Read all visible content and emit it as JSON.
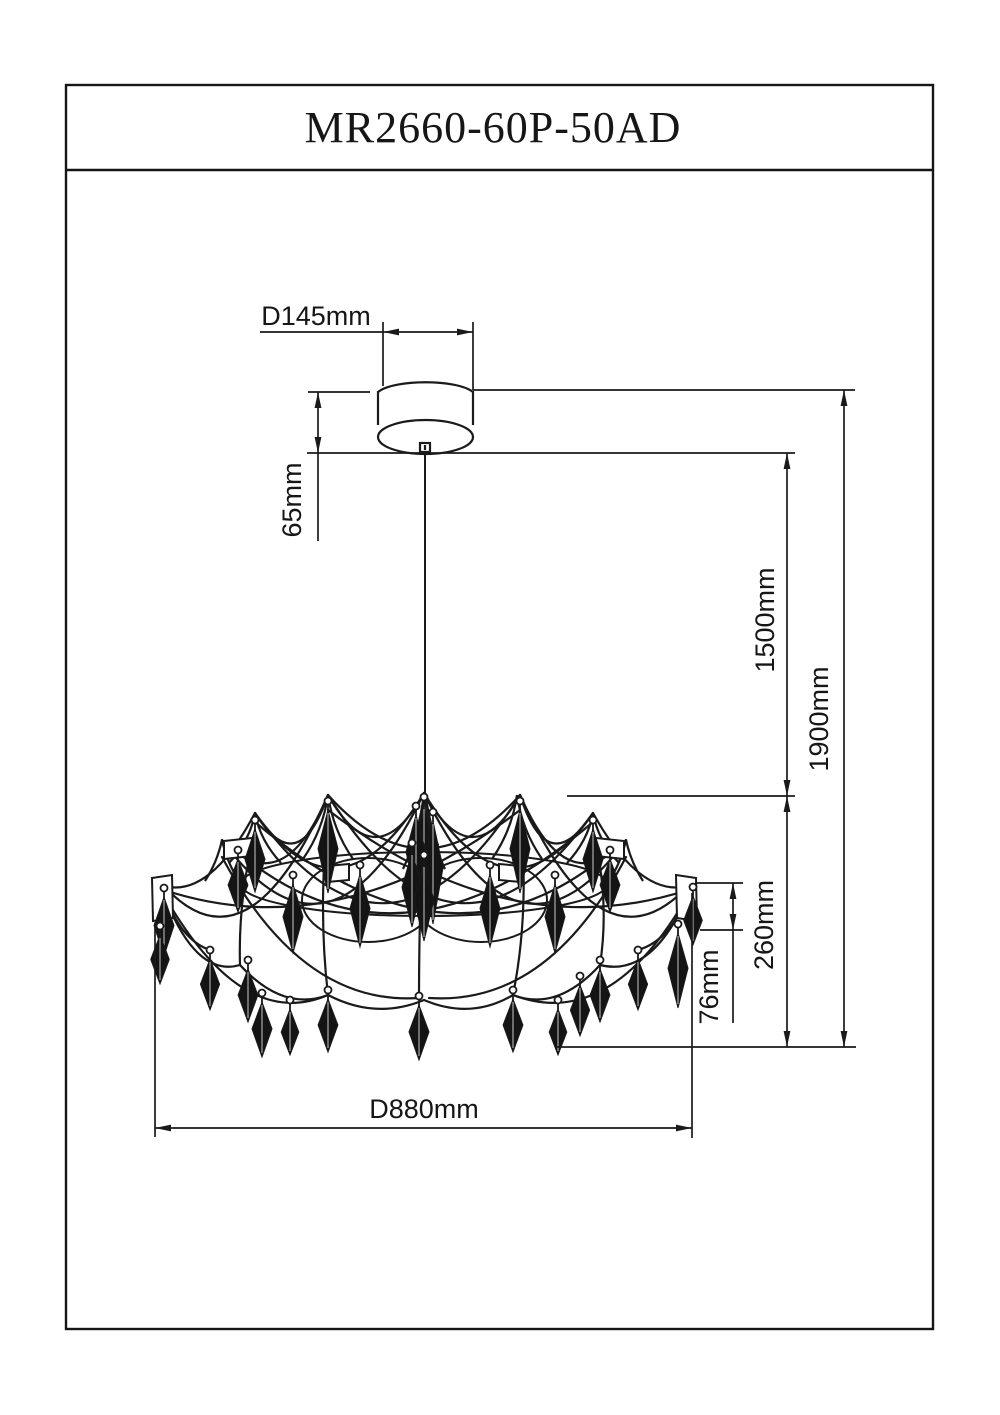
{
  "title": "MR2660-60P-50AD",
  "dimensions": {
    "canopy_diameter": "D145mm",
    "canopy_height": "65mm",
    "cable_length": "1500mm",
    "overall_height": "1900mm",
    "body_height": "260mm",
    "crystal_drop_length": "76mm",
    "fixture_diameter": "D880mm"
  },
  "drawing": {
    "stroke_color": "#1a1a1a",
    "frame": {
      "x": 66,
      "y": 85,
      "w": 867,
      "h": 1244,
      "title_sep_y": 170
    },
    "canopy": {
      "left": 378,
      "right": 473,
      "top": 386,
      "side_bottom": 424,
      "ellipse_cy": 437,
      "ellipse_ry": 17,
      "connector": {
        "x": 420,
        "y": 443,
        "w": 10,
        "h": 9
      }
    },
    "wire": {
      "x": 425,
      "y1": 452,
      "y2": 793
    },
    "ext_lines": [
      [
        308,
        392,
        370,
        392
      ],
      [
        473,
        390,
        855,
        390
      ],
      [
        307,
        453,
        795,
        453
      ],
      [
        567,
        796,
        795,
        796
      ],
      [
        695,
        883,
        743,
        883
      ],
      [
        700,
        930,
        743,
        930
      ],
      [
        555,
        1047,
        856,
        1047
      ],
      [
        155,
        923,
        155,
        1137
      ],
      [
        692,
        893,
        692,
        1138
      ],
      [
        383,
        322,
        383,
        386
      ],
      [
        473,
        322,
        473,
        390
      ]
    ],
    "dim_lines": [
      [
        260,
        332,
        473,
        332
      ],
      [
        318,
        392,
        318,
        541
      ],
      [
        787,
        453,
        787,
        796
      ],
      [
        787,
        796,
        787,
        1047
      ],
      [
        844,
        390,
        844,
        1047
      ],
      [
        733,
        883,
        733,
        1023
      ],
      [
        155,
        1128,
        692,
        1128
      ]
    ],
    "arrows": [
      [
        383,
        332,
        "l"
      ],
      [
        473,
        332,
        "r"
      ],
      [
        318,
        392,
        "u"
      ],
      [
        318,
        453,
        "d"
      ],
      [
        787,
        453,
        "u"
      ],
      [
        787,
        796,
        "d"
      ],
      [
        787,
        796,
        "u"
      ],
      [
        787,
        1047,
        "d"
      ],
      [
        844,
        390,
        "u"
      ],
      [
        844,
        1047,
        "d"
      ],
      [
        733,
        883,
        "u"
      ],
      [
        733,
        930,
        "d"
      ],
      [
        155,
        1128,
        "l"
      ],
      [
        692,
        1128,
        "r"
      ]
    ],
    "labels": [
      {
        "key": "canopy_diameter",
        "x": 316,
        "y": 325,
        "rotate": 0
      },
      {
        "key": "canopy_height",
        "x": 301,
        "y": 500,
        "rotate": -90
      },
      {
        "key": "cable_length",
        "x": 774,
        "y": 620,
        "rotate": -90
      },
      {
        "key": "overall_height",
        "x": 828,
        "y": 719,
        "rotate": -90
      },
      {
        "key": "body_height",
        "x": 773,
        "y": 925,
        "rotate": -90
      },
      {
        "key": "crystal_drop_length",
        "x": 718,
        "y": 987,
        "rotate": -90
      },
      {
        "key": "fixture_diameter",
        "x": 424,
        "y": 1118,
        "rotate": 0
      }
    ],
    "swags": [
      [
        164,
        886,
        210,
        898,
        255,
        813
      ],
      [
        255,
        813,
        298,
        882,
        328,
        795
      ],
      [
        328,
        795,
        376,
        880,
        424,
        793
      ],
      [
        424,
        793,
        472,
        880,
        520,
        795
      ],
      [
        520,
        795,
        548,
        882,
        593,
        813
      ],
      [
        593,
        813,
        640,
        898,
        688,
        886
      ],
      [
        222,
        840,
        283,
        903,
        328,
        795
      ],
      [
        520,
        795,
        567,
        903,
        626,
        840
      ],
      [
        164,
        886,
        248,
        978,
        328,
        795
      ],
      [
        520,
        795,
        602,
        978,
        688,
        886
      ],
      [
        255,
        813,
        340,
        932,
        424,
        793
      ],
      [
        424,
        793,
        508,
        932,
        593,
        813
      ],
      [
        222,
        840,
        330,
        988,
        424,
        793
      ],
      [
        424,
        793,
        518,
        988,
        626,
        840
      ],
      [
        328,
        795,
        424,
        902,
        520,
        795
      ],
      [
        255,
        813,
        390,
        1002,
        520,
        795
      ],
      [
        328,
        795,
        458,
        1002,
        593,
        813
      ],
      [
        238,
        852,
        400,
        988,
        593,
        822
      ],
      [
        610,
        852,
        450,
        988,
        255,
        822
      ],
      [
        164,
        890,
        340,
        948,
        520,
        810
      ],
      [
        688,
        890,
        508,
        948,
        328,
        810
      ],
      [
        164,
        895,
        196,
        978,
        240,
        965
      ],
      [
        240,
        965,
        283,
        1012,
        328,
        995
      ],
      [
        328,
        995,
        376,
        1020,
        424,
        1000
      ],
      [
        424,
        1000,
        471,
        1020,
        513,
        995
      ],
      [
        513,
        995,
        557,
        1012,
        600,
        965
      ],
      [
        600,
        965,
        652,
        978,
        688,
        895
      ],
      [
        164,
        895,
        242,
        1032,
        328,
        995
      ],
      [
        688,
        895,
        610,
        1032,
        513,
        995
      ],
      [
        222,
        857,
        302,
        1006,
        419,
        998
      ],
      [
        626,
        857,
        548,
        1006,
        429,
        998
      ],
      [
        255,
        830,
        238,
        900,
        240,
        965
      ],
      [
        593,
        830,
        610,
        900,
        600,
        965
      ],
      [
        328,
        812,
        318,
        910,
        328,
        995
      ],
      [
        520,
        812,
        530,
        910,
        513,
        995
      ],
      [
        424,
        810,
        419,
        910,
        419,
        998
      ],
      [
        425,
        793,
        419,
        830,
        412,
        845
      ],
      [
        425,
        793,
        431,
        830,
        438,
        845
      ],
      [
        425,
        793,
        420,
        835,
        416,
        868
      ],
      [
        425,
        793,
        430,
        835,
        434,
        868
      ],
      [
        164,
        892,
        180,
        940,
        210,
        950
      ],
      [
        688,
        892,
        672,
        940,
        638,
        950
      ]
    ],
    "ellipses": [
      [
        368,
        900,
        66,
        42
      ],
      [
        481,
        900,
        66,
        42
      ],
      [
        424,
        884,
        183,
        32
      ]
    ],
    "peaks": [
      [
        255,
        813,
        26,
        50
      ],
      [
        328,
        795,
        25,
        64
      ],
      [
        517,
        795,
        25,
        64
      ],
      [
        593,
        813,
        26,
        50
      ],
      [
        222,
        840,
        17,
        41
      ],
      [
        626,
        840,
        17,
        41
      ],
      [
        424,
        793,
        21,
        76
      ]
    ],
    "boxes": [
      [
        224,
        841,
        252,
        838,
        252,
        856,
        224,
        859
      ],
      [
        596,
        838,
        624,
        841,
        624,
        859,
        596,
        856
      ],
      [
        327,
        866,
        349,
        864,
        349,
        880,
        327,
        882
      ],
      [
        499,
        864,
        521,
        866,
        521,
        882,
        499,
        880
      ],
      [
        152,
        878,
        172,
        875,
        173,
        918,
        153,
        921
      ],
      [
        676,
        875,
        696,
        878,
        697,
        921,
        677,
        918
      ]
    ],
    "drops": [
      [
        255,
        820,
        72
      ],
      [
        328,
        801,
        92
      ],
      [
        424,
        797,
        100
      ],
      [
        433,
        812,
        112
      ],
      [
        416,
        806,
        88
      ],
      [
        520,
        801,
        92
      ],
      [
        593,
        820,
        72
      ],
      [
        238,
        850,
        62
      ],
      [
        412,
        843,
        84
      ],
      [
        610,
        850,
        62
      ],
      [
        164,
        888,
        68
      ],
      [
        160,
        926,
        58
      ],
      [
        693,
        887,
        58
      ],
      [
        678,
        924,
        84
      ],
      [
        360,
        865,
        82
      ],
      [
        490,
        865,
        82
      ],
      [
        293,
        875,
        78
      ],
      [
        555,
        875,
        78
      ],
      [
        424,
        855,
        86
      ],
      [
        210,
        950,
        60
      ],
      [
        638,
        950,
        60
      ],
      [
        248,
        960,
        62
      ],
      [
        600,
        960,
        62
      ],
      [
        262,
        993,
        64
      ],
      [
        328,
        990,
        62
      ],
      [
        419,
        996,
        64
      ],
      [
        513,
        990,
        62
      ],
      [
        580,
        976,
        60
      ],
      [
        290,
        1000,
        55
      ],
      [
        558,
        1000,
        55
      ]
    ]
  }
}
